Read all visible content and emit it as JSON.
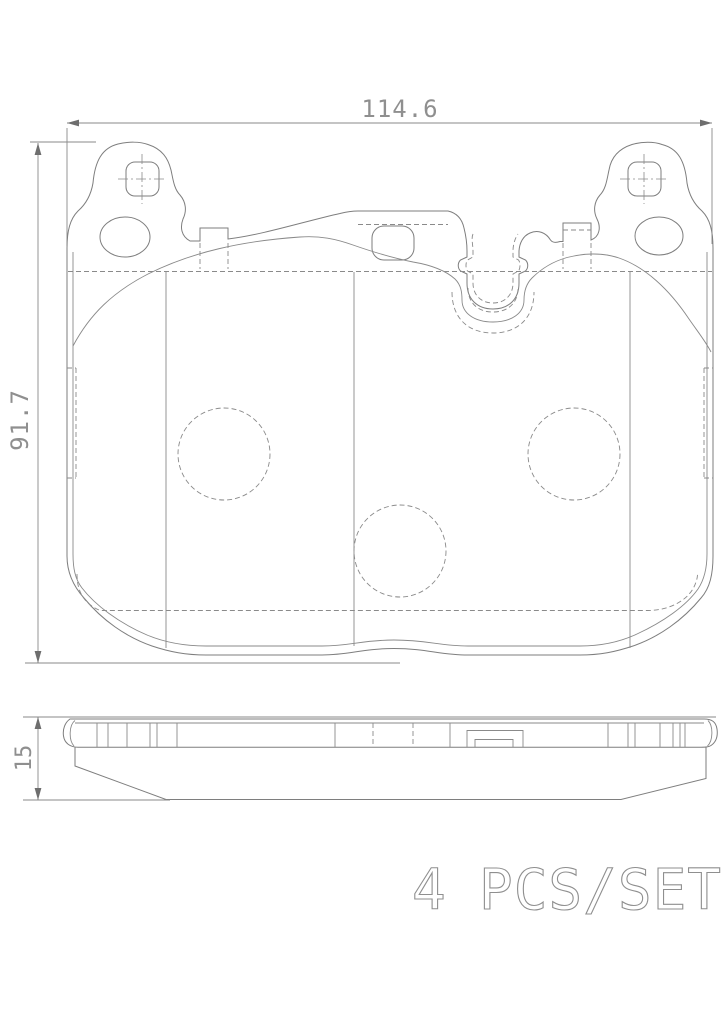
{
  "drawing": {
    "width_dimension": "114.6",
    "height_dimension": "91.7",
    "thickness_dimension": "15",
    "quantity": "4",
    "unit_label": "PCS/SET",
    "colors": {
      "line": "#7e7e7e",
      "label": "#8f8f8f",
      "background": "#ffffff"
    }
  }
}
